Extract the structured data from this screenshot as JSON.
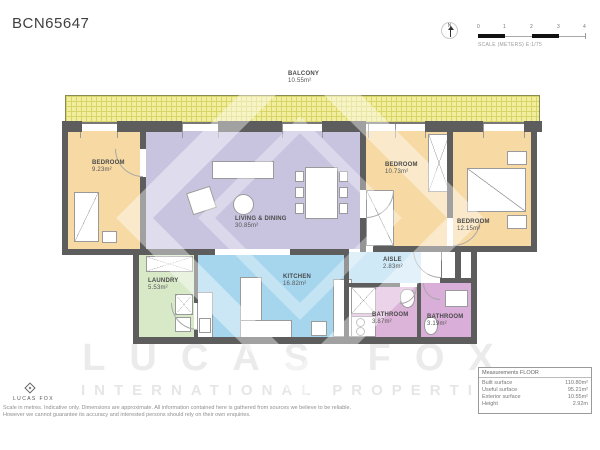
{
  "title": "BCN65647",
  "compass": {
    "north_label": "N"
  },
  "scale_bar": {
    "ticks": [
      "0",
      "1",
      "2",
      "3",
      "4"
    ],
    "caption": "SCALE (METERS) E:1/75"
  },
  "rooms": [
    {
      "name": "BALCONY",
      "area": "10.55m²"
    },
    {
      "name": "BEDROOM",
      "area": "9.23m²"
    },
    {
      "name": "LIVING & DINING",
      "area": "30.85m²"
    },
    {
      "name": "BEDROOM",
      "area": "10.73m²"
    },
    {
      "name": "BEDROOM",
      "area": "12.15m²"
    },
    {
      "name": "LAUNDRY",
      "area": "5.53m²"
    },
    {
      "name": "KITCHEN",
      "area": "16.82m²"
    },
    {
      "name": "AISLE",
      "area": "2.83m²"
    },
    {
      "name": "BATHROOM",
      "area": "3.87m²"
    },
    {
      "name": "BATHROOM",
      "area": "3.19m²"
    }
  ],
  "watermark": {
    "line1": "LUCAS FOX",
    "line2": "INTERNATIONAL PROPERTIES"
  },
  "footer": {
    "logo_text": "LUCAS FOX",
    "disclaimer_line1": "Scale in metres. Indicative only. Dimensions are approximate. All information contained here is gathered from sources we believe to be reliable.",
    "disclaimer_line2": "However we cannot guarantee its accuracy and interested persons should rely on their own enquiries."
  },
  "measurements": {
    "header": "Measurements FLOOR",
    "rows": [
      {
        "label": "Built surface",
        "value": "110.80m²"
      },
      {
        "label": "Useful surface",
        "value": "95.21m²"
      },
      {
        "label": "Exterior surface",
        "value": "10.55m²"
      },
      {
        "label": "Height",
        "value": "2.92m"
      }
    ]
  },
  "colors": {
    "balcony": "#f1ee9e",
    "bedroom": "#f7d9a4",
    "living": "#c8c4e0",
    "laundry": "#d8e9c8",
    "kitchen": "#a5d6ee",
    "aisle": "#cfe9f6",
    "bathroom": "#dcb3d9",
    "walls": "#5d5d5d"
  }
}
